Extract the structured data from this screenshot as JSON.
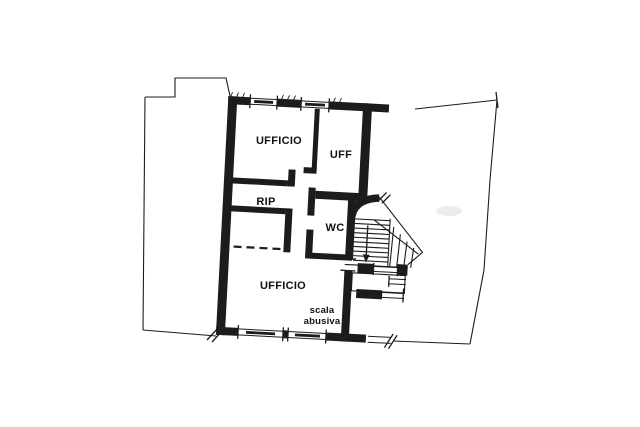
{
  "document": {
    "type": "cadastral floor plan",
    "paper_color": "#ffffff",
    "ink_color": "#1c1c1c"
  },
  "rooms": [
    {
      "name": "ufficio-top",
      "label": "UFFICIO"
    },
    {
      "name": "uff",
      "label": "UFF"
    },
    {
      "name": "rip",
      "label": "RIP"
    },
    {
      "name": "wc",
      "label": "WC"
    },
    {
      "name": "ufficio-bottom",
      "label": "UFFICIO"
    }
  ],
  "annotations": {
    "stair_note_line1": "scala",
    "stair_note_line2": "abusiva"
  }
}
